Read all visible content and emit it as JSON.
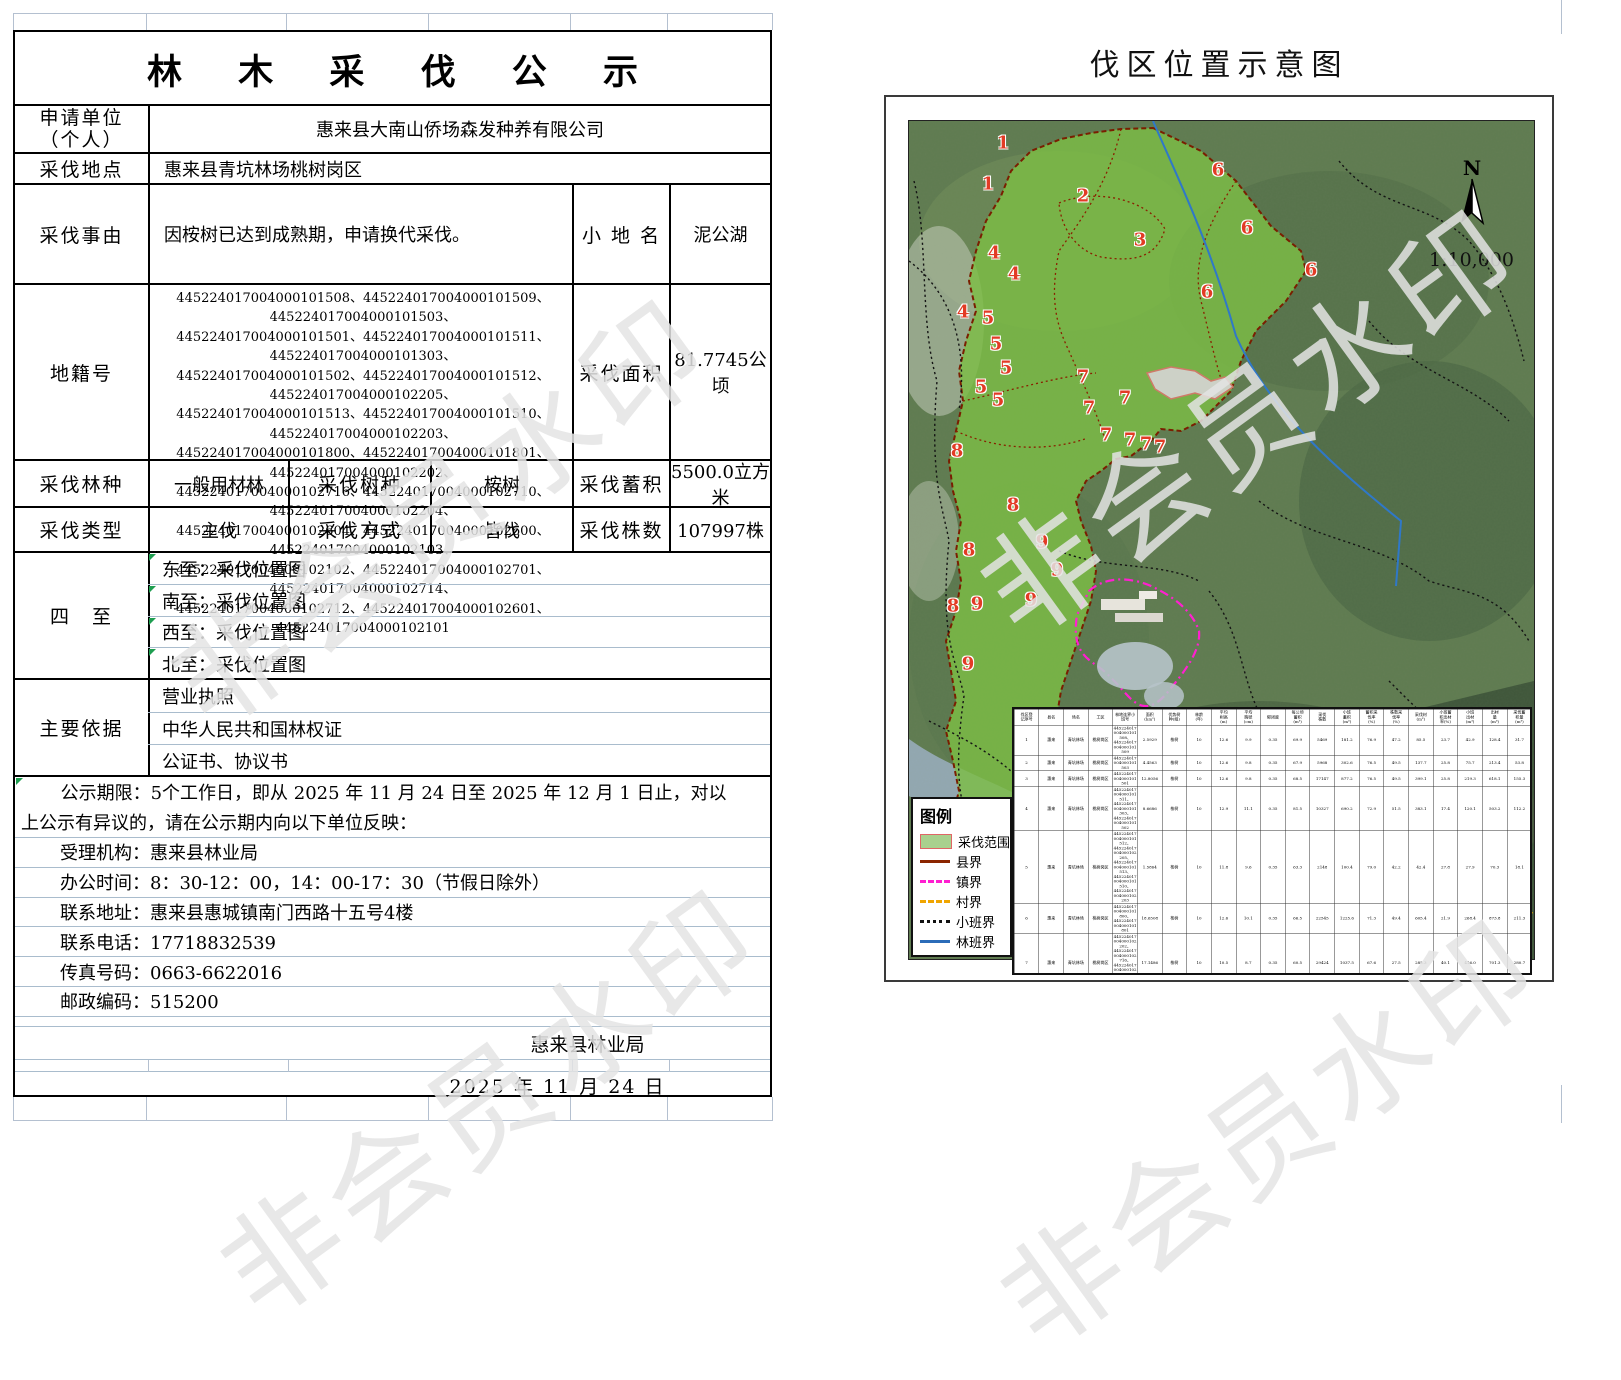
{
  "watermark": {
    "text": "非会员水印"
  },
  "form": {
    "title": "林 木 采 伐 公 示",
    "applicant": {
      "label_line1": "申请单位",
      "label_line2": "（个人）",
      "value": "惠来县大南山侨场森发种养有限公司"
    },
    "location": {
      "label": "采伐地点",
      "value": "惠来县青坑林场桃树岗区"
    },
    "reason": {
      "label": "采伐事由",
      "value": "因桉树已达到成熟期，申请换代采伐。",
      "place_label": "小 地 名",
      "place_value": "泥公湖"
    },
    "cadastral": {
      "label": "地籍号",
      "lines": [
        "445224017004000101508、445224017004000101509、445224017004000101503、",
        "445224017004000101501、445224017004000101511、445224017004000101303、",
        "445224017004000101502、445224017004000101512、445224017004000102205、",
        "445224017004000101513、445224017004000101510、445224017004000102203、",
        "445224017004000101800、445224017004000101801、445224017004000102202、",
        "445224017004000102716、445224017004000102710、445224017004000102204、",
        "445224017004000102604、445224017004000102600、445224017004000102103、",
        "445224017004000102102、445224017004000102701、445224017004000102714、",
        "445224017004000102712、445224017004000102601、445224017004000102101"
      ],
      "area_label": "采伐面积",
      "area_value": "81.7745公顷"
    },
    "forest": {
      "label": "采伐林种",
      "value": "一般用材林",
      "species_label": "采伐树种",
      "species_value": "桉树",
      "volume_label": "采伐蓄积",
      "volume_value": "5500.0立方米"
    },
    "type": {
      "label": "采伐类型",
      "value": "主伐",
      "method_label": "采伐方式",
      "method_value": "皆伐",
      "count_label": "采伐株数",
      "count_value": "107997株"
    },
    "bounds": {
      "label": "四　至",
      "items": [
        "东至：采伐位置图",
        "南至：采伐位置图",
        "西至：采伐位置图",
        "北至：采伐位置图"
      ]
    },
    "basis": {
      "label": "主要依据",
      "items": [
        "营业执照",
        "中华人民共和国林权证",
        "公证书、协议书"
      ]
    },
    "notice": {
      "line1": "公示期限：5个工作日，即从 2025 年 11 月 24 日至 2025 年 12 月 1 日止，对以",
      "line2": "上公示有异议的，请在公示期内向以下单位反映："
    },
    "contacts": [
      "受理机构：惠来县林业局",
      "办公时间：8：30-12：00，14：00-17：30（节假日除外）",
      "联系地址：惠来县惠城镇南门西路十五号4楼",
      "联系电话：17718832539",
      "传真号码：0663-6622016",
      "邮政编码：515200"
    ],
    "footer": {
      "org": "惠来县林业局",
      "date": "2025 年 11 月 24 日"
    }
  },
  "map": {
    "title": "伐区位置示意图",
    "north_label": "N",
    "scale_text": "1:10,000",
    "colors": {
      "harvest_fill": "#7cbd45",
      "county": "#8b2500",
      "town": "#ff1fd0",
      "village": "#f0a500",
      "subplot": "#141414",
      "forest": "#2f78c8"
    },
    "legend": {
      "title": "图例",
      "items": [
        {
          "label": "采伐范围",
          "type": "swatch"
        },
        {
          "label": "县界",
          "type": "county"
        },
        {
          "label": "镇界",
          "type": "town"
        },
        {
          "label": "村界",
          "type": "village"
        },
        {
          "label": "小班界",
          "type": "subplot"
        },
        {
          "label": "林班界",
          "type": "forest"
        }
      ]
    },
    "labels": [
      {
        "n": "1",
        "x": 95,
        "y": 23
      },
      {
        "n": "1",
        "x": 80,
        "y": 64
      },
      {
        "n": "2",
        "x": 175,
        "y": 76
      },
      {
        "n": "3",
        "x": 232,
        "y": 120
      },
      {
        "n": "4",
        "x": 86,
        "y": 133
      },
      {
        "n": "4",
        "x": 106,
        "y": 154
      },
      {
        "n": "4",
        "x": 55,
        "y": 192
      },
      {
        "n": "5",
        "x": 80,
        "y": 198
      },
      {
        "n": "5",
        "x": 88,
        "y": 224
      },
      {
        "n": "5",
        "x": 98,
        "y": 248
      },
      {
        "n": "5",
        "x": 73,
        "y": 267
      },
      {
        "n": "5",
        "x": 90,
        "y": 280
      },
      {
        "n": "6",
        "x": 310,
        "y": 50
      },
      {
        "n": "6",
        "x": 339,
        "y": 108
      },
      {
        "n": "6",
        "x": 403,
        "y": 150
      },
      {
        "n": "6",
        "x": 299,
        "y": 172
      },
      {
        "n": "7",
        "x": 175,
        "y": 257
      },
      {
        "n": "7",
        "x": 217,
        "y": 278
      },
      {
        "n": "7",
        "x": 181,
        "y": 288
      },
      {
        "n": "7",
        "x": 198,
        "y": 315
      },
      {
        "n": "7",
        "x": 222,
        "y": 320
      },
      {
        "n": "7",
        "x": 238,
        "y": 324
      },
      {
        "n": "7",
        "x": 252,
        "y": 327
      },
      {
        "n": "8",
        "x": 49,
        "y": 331
      },
      {
        "n": "8",
        "x": 105,
        "y": 385
      },
      {
        "n": "8",
        "x": 61,
        "y": 430
      },
      {
        "n": "8",
        "x": 45,
        "y": 486
      },
      {
        "n": "9",
        "x": 134,
        "y": 422
      },
      {
        "n": "9",
        "x": 149,
        "y": 450
      },
      {
        "n": "9",
        "x": 123,
        "y": 480
      },
      {
        "n": "9",
        "x": 69,
        "y": 484
      },
      {
        "n": "9",
        "x": 60,
        "y": 544
      }
    ],
    "table": {
      "headers": [
        "伐区登\n记序号",
        "县名",
        "场名",
        "工区",
        "林地连界小班号",
        "面积\n(hm²)",
        "优势树\n种(组)",
        "林龄\n(年)",
        "平均\n树高\n(m)",
        "平均\n胸径\n(cm)",
        "郁闭度",
        "每公顷\n蓄积\n(m³)",
        "采伐\n株数",
        "小班\n蓄积\n(m³)",
        "蓄积采\n伐率\n(%)",
        "株数采\n伐率\n(%)",
        "采伐材\n(m³)",
        "小班蓄\n积出材\n率(%)",
        "小班\n出材\n(m³)",
        "出材\n量\n(m³)",
        "采伐蓄\n积量\n(m³)"
      ],
      "rows": [
        [
          "1",
          "惠来",
          "青坑林场",
          "桃树岗区",
          "445224017004000101508、\n445224017004000101509",
          "2.5929",
          "桉树",
          "10",
          "12.6",
          "9.9",
          "0.35",
          "69.9",
          "5469",
          "181.2",
          "76.9",
          "47.2",
          "85.5",
          "23.7",
          "42.9",
          "128.4",
          "31.7"
        ],
        [
          "2",
          "惠来",
          "青坑林场",
          "桃树岗区",
          "445224017004000101503",
          "4.4563",
          "桉树",
          "10",
          "12.6",
          "9.8",
          "0.35",
          "67.9",
          "5968",
          "302.6",
          "76.5",
          "49.5",
          "137.7",
          "25.8",
          "75.7",
          "213.4",
          "53.8"
        ],
        [
          "3",
          "惠来",
          "青坑林场",
          "桃树岗区",
          "445224017004000101501",
          "12.8056",
          "桉树",
          "10",
          "12.6",
          "9.8",
          "0.35",
          "68.5",
          "17147",
          "877.2",
          "76.5",
          "49.5",
          "399.1",
          "25.8",
          "219.3",
          "618.1",
          "155.3"
        ],
        [
          "4",
          "惠来",
          "青坑林场",
          "桃树岗区",
          "445224017004000101511、\n445224017004000101303、\n445224017004000101502",
          "8.6686",
          "桉树",
          "10",
          "12.9",
          "11.1",
          "0.35",
          "81.5",
          "10327",
          "690.2",
          "72.9",
          "51.5",
          "383.1",
          "17.4",
          "120.1",
          "503.2",
          "112.2"
        ],
        [
          "5",
          "惠来",
          "青坑林场",
          "桃树岗区",
          "445224017004000101512、\n445224017004000102205、\n445224017004000101513、\n445224017004000101510、\n445224017004000102203",
          "1.5864",
          "桉树",
          "10",
          "11.8",
          "9.6",
          "0.35",
          "63.3",
          "2148",
          "100.4",
          "79.0",
          "42.2",
          "42.4",
          "27.8",
          "27.9",
          "70.3",
          "18.1"
        ],
        [
          "6",
          "惠来",
          "青坑林场",
          "桃树岗区",
          "445224017004000101800、\n445224017004000101801",
          "18.6508",
          "桉树",
          "10",
          "12.6",
          "10.1",
          "0.35",
          "66.5",
          "22545",
          "1225.6",
          "71.3",
          "49.4",
          "605.4",
          "21.9",
          "268.4",
          "873.8",
          "211.3"
        ],
        [
          "7",
          "惠来",
          "青坑林场",
          "桃树岗区",
          "445224017004000102202、\n445224017004000102716、\n445224017004000102710、\n445224017004000102204",
          "17.1486",
          "桉树",
          "10",
          "10.5",
          "8.7",
          "0.35",
          "60.5",
          "29424",
          "1037.5",
          "67.6",
          "27.5",
          "285.3",
          "40.1",
          "416.0",
          "701.3",
          "280.7"
        ],
        [
          "8",
          "惠来",
          "青坑林场",
          "桃树岗区",
          "445224017004000102604、\n445224017004000102600、\n445224017004000102103、\n445224017004000102102",
          "15.2865",
          "桉树",
          "10",
          "10.8",
          "11.9",
          "0.35",
          "67.2",
          "15256",
          "1027.3",
          "74.2",
          "60.4",
          "620.5",
          "13.8",
          "141.8",
          "762.3",
          "159.8"
        ],
        [
          "9",
          "惠来",
          "青坑林场",
          "桃树岗区",
          "445224017004000102701、\n445224017004000102714、\n445224017004000102712、\n445224017004000102601、\n445224017004000102101",
          "0.9996",
          "桉树",
          "10",
          "9.1",
          "8.8",
          "0.35",
          "58.0",
          "1775",
          "58.0",
          "67.8",
          "29.1",
          "16.5",
          "56.6",
          "22.4",
          "39.3",
          "11.2"
        ]
      ],
      "total": [
        "",
        "合计",
        "",
        "",
        "",
        "81.7745",
        "",
        "",
        "",
        "",
        "",
        "",
        "107997",
        "5500.0",
        "",
        "",
        "2573.9",
        "",
        "1354.5",
        "3910.4",
        "953.6"
      ]
    }
  }
}
